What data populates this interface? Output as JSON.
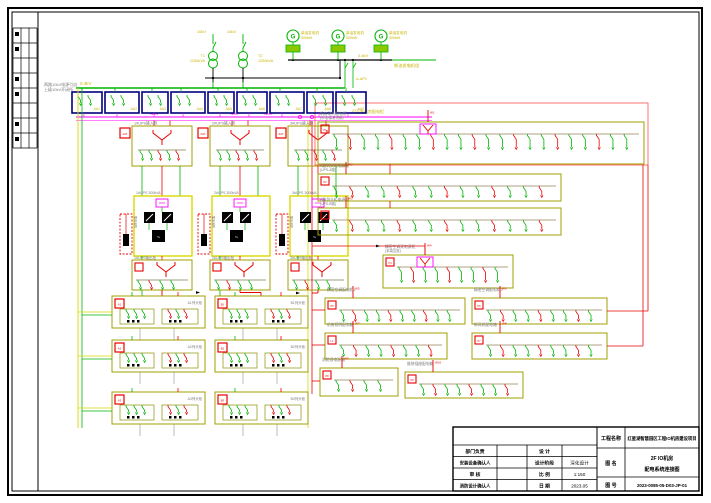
{
  "palette": {
    "green": "#00b400",
    "yellow": "#c8b400",
    "magenta": "#ff00ff",
    "red": "#e80000",
    "navy": "#000080",
    "olive": "#a0a000",
    "grey": "#7a7a7a",
    "black": "#000000",
    "bg": "#ffffff"
  },
  "top": {
    "hv_note": [
      "两路10kV电源引自",
      "上级10kV开闭所"
    ],
    "hv_label": "10kV",
    "transformers": [
      {
        "tag": "T1",
        "rating": "1250kVA"
      },
      {
        "tag": "T2",
        "rating": "1250kVA"
      }
    ],
    "lv_bus_label": "0.4kV",
    "generators": [
      {
        "label": "柴油发电机",
        "note": "500kW"
      },
      {
        "label": "柴油发电机",
        "note": "500kW"
      },
      {
        "label": "柴油发电机",
        "note": "500kW"
      }
    ],
    "gen_bus_label": "0.4kV",
    "gen_bus_name": "柴油发电机组",
    "gen_feeder": "A-AP1"
  },
  "switch_row": {
    "boxes": [
      "AA1",
      "AA2",
      "AA3",
      "AA4",
      "AA5",
      "AA6",
      "AA7",
      "AA8",
      "AA9"
    ]
  },
  "feeder_bus": {
    "segments": [
      "WM1",
      "WM2",
      "WM3"
    ],
    "note": "引至各机房配电柜"
  },
  "chains": [
    {
      "tag": "1AT",
      "title": "1#UPS输入柜",
      "ups": "1#UPS 300kVA",
      "battery": "蓄电池柜",
      "out": "1#UPS输出柜"
    },
    {
      "tag": "2AT",
      "title": "2#UPS输入柜",
      "ups": "2#UPS 300kVA",
      "battery": "蓄电池柜",
      "out": "2#UPS输出柜"
    },
    {
      "tag": "3AT",
      "title": "3#UPS输入柜",
      "ups": "3#UPS 300kVA",
      "battery": "蓄电池柜",
      "out": "3#UPS输出柜"
    }
  ],
  "rack_rows": [
    {
      "tag": "A1",
      "name": "A1列头柜"
    },
    {
      "tag": "B1",
      "name": "B1列头柜"
    },
    {
      "tag": "A2",
      "name": "A2列头柜"
    },
    {
      "tag": "B2",
      "name": "B2列头柜"
    },
    {
      "tag": "A3",
      "name": "A3列头柜"
    },
    {
      "tag": "B3",
      "name": "B3列头柜"
    }
  ],
  "right_panels": [
    {
      "tag": "P1",
      "name": "机房动力配电柜",
      "sub": "(市电/柴发切换)",
      "feeder": "W1"
    },
    {
      "tag": "P2",
      "name": "A路列头柜电源柜",
      "sub": "(UPS-A路)",
      "feeder": "W2"
    },
    {
      "tag": "P3",
      "name": "B路列头柜电源柜",
      "sub": "(UPS-B路)",
      "feeder": "W3"
    },
    {
      "tag": "P4",
      "name": "精密空调双电源柜",
      "sub": "(末端互投)",
      "feeder": "W4"
    },
    {
      "tag": "P5",
      "name": "精密空调配电柜1",
      "sub": "",
      "feeder": "W5"
    },
    {
      "tag": "P6",
      "name": "精密空调配电柜2",
      "sub": "",
      "feeder": "W6"
    },
    {
      "tag": "L1",
      "name": "机房照明配电箱",
      "sub": "",
      "feeder": "W7"
    },
    {
      "tag": "P7",
      "name": "新风机配电箱",
      "sub": "",
      "feeder": "W8"
    },
    {
      "tag": "P8",
      "name": "消防双电源箱",
      "sub": "",
      "feeder": "W9"
    },
    {
      "tag": "P9",
      "name": "维修插座配电箱",
      "sub": "",
      "feeder": "W10"
    }
  ],
  "titleblock": {
    "rows_left": [
      [
        "部门负责",
        ""
      ],
      [
        "安装设备确认人",
        ""
      ],
      [
        "审 核",
        ""
      ],
      [
        "消防设计确认人",
        ""
      ]
    ],
    "rows_mid": [
      [
        "设 计",
        ""
      ],
      [
        "设计阶段",
        "深化设计"
      ],
      [
        "比 例",
        "1:150"
      ],
      [
        "日 期",
        "2023.05"
      ]
    ],
    "project_label": "工程名称",
    "project_name": "红星湖智慧园区工程IO机房建设项目",
    "drawing_label": "图 名",
    "drawing_name1": "2F IO机房",
    "drawing_name2": "配电系统连接图",
    "number_label": "图 号",
    "number": "2023-0085-05-D03-JP-01"
  }
}
